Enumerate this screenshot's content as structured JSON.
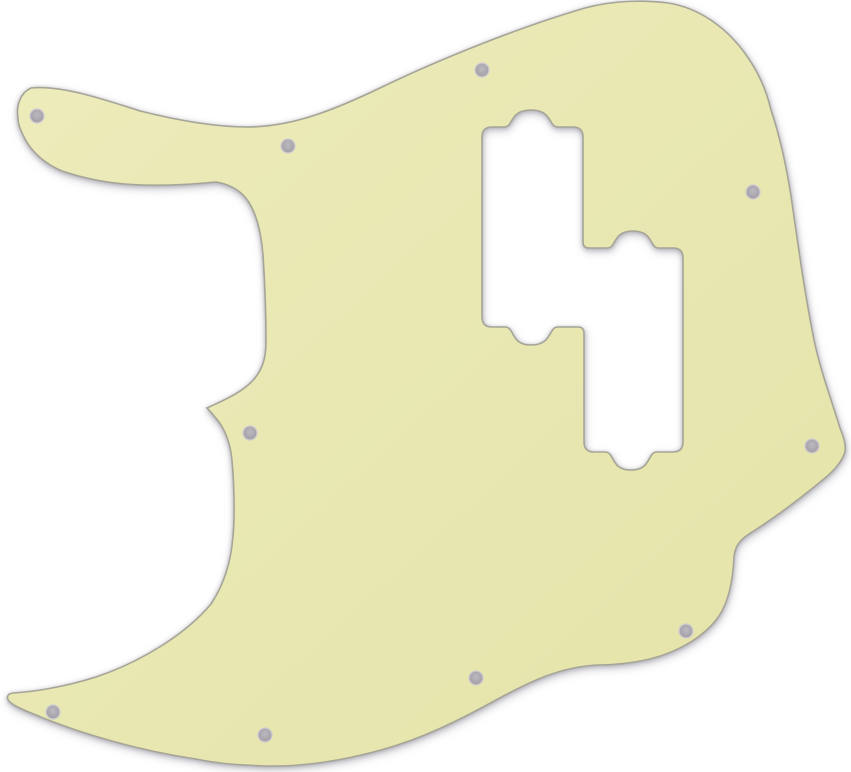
{
  "page": {
    "background_color": "#ffffff"
  },
  "pickguard": {
    "description": "Mint cream colored Jazz Bass style pickguard blank shown flat on a white background, with a combined staircase-shaped dual pickup cutout (each pickup opening has rounded mounting-ear bumps) and ten countersunk screw holes around the perimeter",
    "colors": {
      "body_light": "#edecbb",
      "body": "#e4e3a8",
      "edge": "#a6a598",
      "hole_fill_center": "#bdb9c0",
      "hole_fill_edge": "#9e9aa2",
      "hole_ring": "#cfcbd1",
      "shadow": "rgba(120,120,135,0.45)"
    },
    "screw_hole_count": 10,
    "screw_holes": [
      {
        "cx": 37,
        "cy": 116,
        "r": 7
      },
      {
        "cx": 288,
        "cy": 146,
        "r": 7
      },
      {
        "cx": 482,
        "cy": 70,
        "r": 7
      },
      {
        "cx": 753,
        "cy": 192,
        "r": 7
      },
      {
        "cx": 250,
        "cy": 433,
        "r": 7
      },
      {
        "cx": 53,
        "cy": 712,
        "r": 7
      },
      {
        "cx": 265,
        "cy": 735,
        "r": 7
      },
      {
        "cx": 812,
        "cy": 446,
        "r": 7
      },
      {
        "cx": 686,
        "cy": 631,
        "r": 7
      },
      {
        "cx": 476,
        "cy": 678,
        "r": 7
      }
    ],
    "shape_path": "M 18,118 C 16,106 20,93 31,88 C 60,85 100,98 140,111 C 180,121 215,127 247,127 C 290,127 330,112 380,88 C 440,59 520,27 585,8 C 615,0 646,0 668,3 C 700,8 726,28 744,52 C 758,71 766,89 771,110 C 780,137 786,164 791,196 C 798,244 804,290 814,340 C 820,369 831,399 840,428 C 844,438 846,444 845,452 C 842,461 836,469 825,478 C 801,498 776,517 749,534 C 740,540 735,546 734,557 C 733,580 729,601 719,616 C 706,635 681,651 650,659 C 633,663 616,665 597,665 C 560,667 531,681 496,700 C 456,722 421,739 381,750 C 341,761 301,767 264,766 C 241,765 220,764 196,759 C 141,751 81,734 36,715 C 26,711 16,707 11,703 C 6,699 6,694 13,693 C 31,692 61,688 96,677 C 141,662 186,634 211,604 C 223,586 231,563 233,536 C 235,516 234,481 232,461 C 231,448 227,433 219,422 C 215,417 211,412 207,408 C 222,401 244,392 255,378 C 263,368 266,357 266,342 C 266,315 265,285 263,255 C 261,230 256,210 245,197 C 238,189 228,184 216,182 C 195,184 160,187 125,184 C 100,182 80,177 62,171 C 45,164 32,152 25,139 C 21,131 18,125 18,118 Z M 482,137 Q 482,127 492,127 L 504,127 C 514,127 509,110 531,110 C 553,110 548,127 558,127 L 573,127 Q 583,127 583,137 L 583,242 Q 583,248 589,248 L 607,248 C 617,248 612,231 633,231 C 654,231 649,248 659,248 L 673,248 Q 683,248 683,258 L 683,442 Q 683,452 673,452 L 657,452 C 647,452 652,470 631,470 C 610,470 615,452 605,452 L 594,452 Q 584,452 584,442 L 584,333 Q 584,327 578,327 L 558,327 C 548,327 553,345 531,345 C 510,345 515,327 505,327 L 492,327 Q 482,327 482,317 Z"
  }
}
